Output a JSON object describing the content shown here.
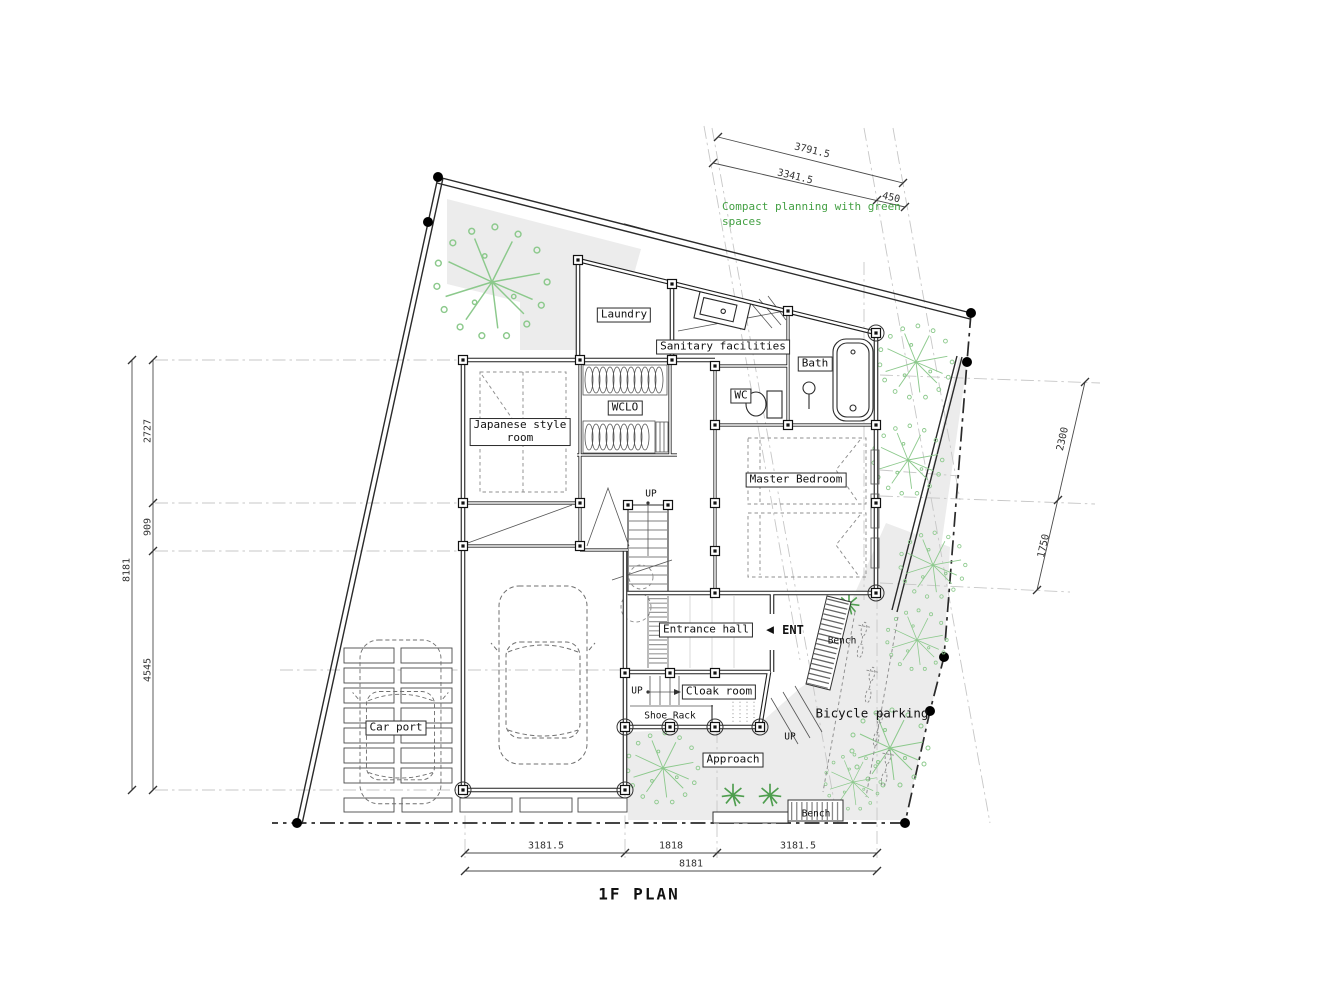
{
  "title": "1F PLAN",
  "note": {
    "line1": "Compact planning with green",
    "line2": "spaces"
  },
  "rooms": {
    "laundry": "Laundry",
    "sanitary": "Sanitary facilities",
    "bath": "Bath",
    "wc": "WC",
    "wclo": "WCLO",
    "japanese_line1": "Japanese style",
    "japanese_line2": "room",
    "master": "Master Bedroom",
    "entrance": "Entrance hall",
    "cloak": "Cloak room",
    "shoe_rack": "Shoe Rack",
    "carport": "Car port",
    "approach": "Approach",
    "bicycle": "Bicycle parking"
  },
  "labels": {
    "up": "UP",
    "ent": "ENT",
    "ent_arrow": "◀",
    "bench": "Bench"
  },
  "dimensions": {
    "top": [
      "3791.5",
      "3341.5",
      "450"
    ],
    "left": [
      "2727",
      "909",
      "4545",
      "8181"
    ],
    "right": [
      "2300",
      "1750"
    ],
    "bottom": [
      "3181.5",
      "1818",
      "3181.5",
      "8181"
    ]
  },
  "colors": {
    "green_text": "#44a044",
    "tree_green": "#8cc98c",
    "fill_gray": "#ececec"
  }
}
